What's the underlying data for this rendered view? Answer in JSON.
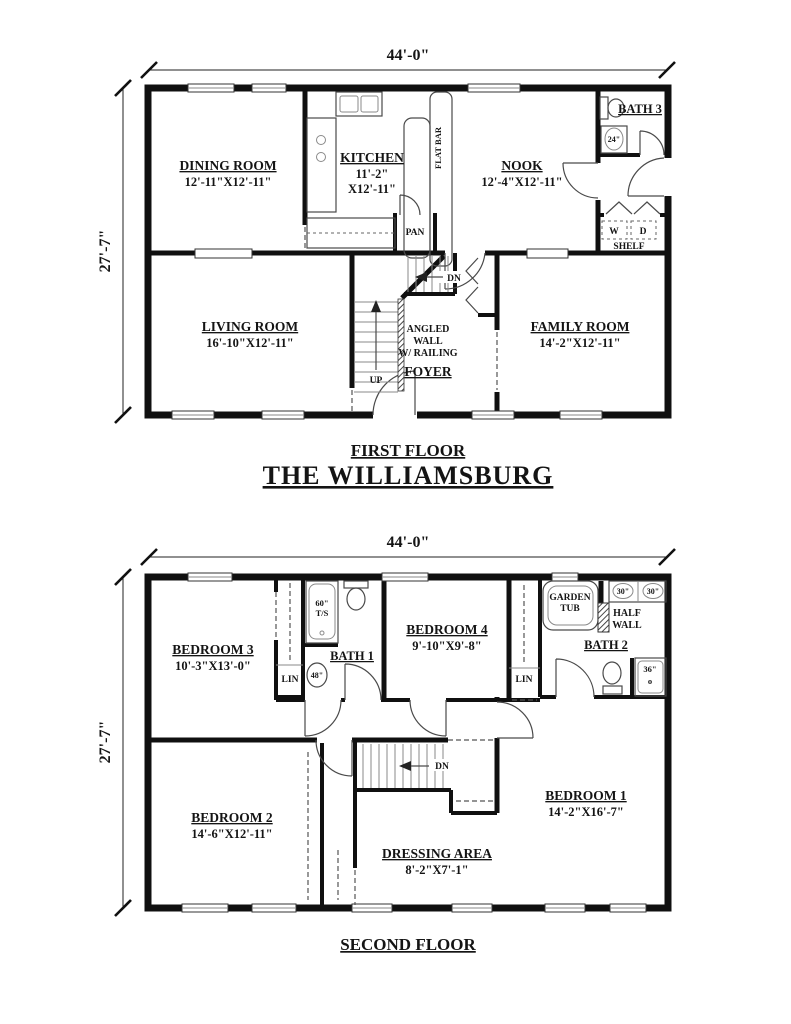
{
  "plan_title": "THE WILLIAMSBURG",
  "colors": {
    "wall": "#101010",
    "background": "#ffffff"
  },
  "floor1": {
    "caption": "FIRST FLOOR",
    "dim_width": "44'-0\"",
    "dim_height": "27'-7\"",
    "rooms": {
      "dining": {
        "name": "DINING ROOM",
        "size": "12'-11\"X12'-11\""
      },
      "kitchen": {
        "name": "KITCHEN",
        "size1": "11'-2\"",
        "size2": "X12'-11\""
      },
      "nook": {
        "name": "NOOK",
        "size": "12'-4\"X12'-11\""
      },
      "bath3": {
        "name": "BATH 3"
      },
      "living": {
        "name": "LIVING ROOM",
        "size": "16'-10\"X12'-11\""
      },
      "family": {
        "name": "FAMILY ROOM",
        "size": "14'-2\"X12'-11\""
      },
      "foyer": {
        "name": "FOYER"
      }
    },
    "labels": {
      "flat_bar": "FLAT BAR",
      "pan": "PAN",
      "dn": "DN",
      "up": "UP",
      "angled1": "ANGLED",
      "angled2": "WALL",
      "angled3": "W/ RAILING",
      "washer": "W",
      "dryer": "D",
      "shelf": "SHELF",
      "vanity24": "24\""
    }
  },
  "floor2": {
    "caption": "SECOND FLOOR",
    "dim_width": "44'-0\"",
    "dim_height": "27'-7\"",
    "rooms": {
      "bedroom1": {
        "name": "BEDROOM 1",
        "size": "14'-2\"X16'-7\""
      },
      "bedroom2": {
        "name": "BEDROOM 2",
        "size": "14'-6\"X12'-11\""
      },
      "bedroom3": {
        "name": "BEDROOM 3",
        "size": "10'-3\"X13'-0\""
      },
      "bedroom4": {
        "name": "BEDROOM 4",
        "size": "9'-10\"X9'-8\""
      },
      "bath1": {
        "name": "BATH 1"
      },
      "bath2": {
        "name": "BATH 2"
      },
      "dressing": {
        "name": "DRESSING AREA",
        "size": "8'-2\"X7'-1\""
      }
    },
    "labels": {
      "tub60a": "60\"",
      "tub60b": "T/S",
      "lin_left": "LIN",
      "lin_right": "LIN",
      "vanity48": "48\"",
      "garden1": "GARDEN",
      "garden2": "TUB",
      "sink30_left": "30\"",
      "sink30_right": "30\"",
      "half1": "HALF",
      "half2": "WALL",
      "shower36": "36\"",
      "shower_o": "o",
      "dn": "DN"
    }
  }
}
